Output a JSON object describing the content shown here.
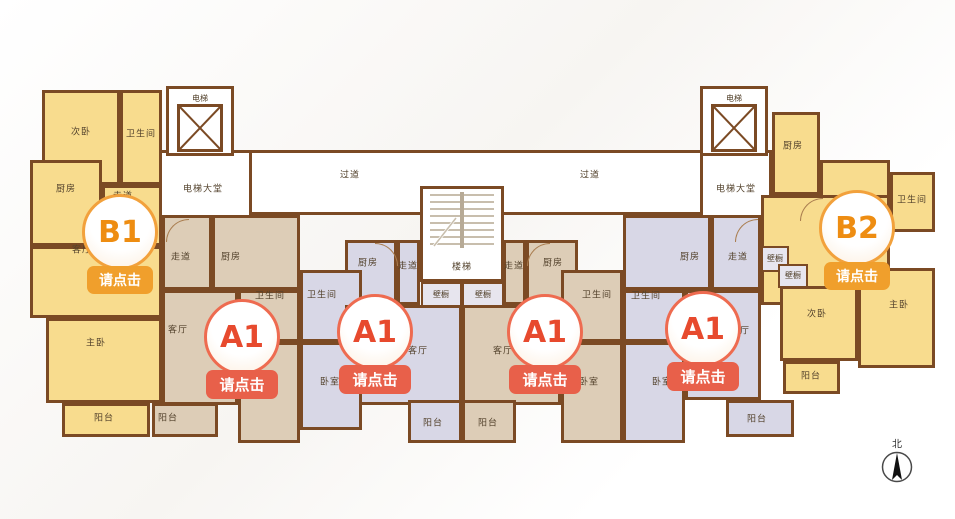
{
  "colors": {
    "wall": "#7b4a24",
    "unit_yellow": "#f8dc8e",
    "unit_tan": "#ddcdb7",
    "unit_lavender": "#d8d7e6",
    "closet_grey": "#e7e5ee",
    "badge_orange": "#f09f2c",
    "badge_red": "#e8604a"
  },
  "core": {
    "passage_left": "过道",
    "passage_right": "过道",
    "lobby_left": "电梯大堂",
    "lobby_right": "电梯大堂",
    "elevator_left": "电梯",
    "elevator_right": "电梯",
    "stairs": "楼梯",
    "closet_left": "壁橱",
    "closet_right": "壁橱"
  },
  "units": {
    "b1": {
      "id": "B1",
      "button": "请点击",
      "rooms": {
        "bedroom2": "次卧",
        "bathroom": "卫生间",
        "kitchen": "厨房",
        "hallway": "走道",
        "living": "客厅",
        "master": "主卧",
        "balcony": "阳台"
      }
    },
    "a1_first": {
      "id": "A1",
      "button": "请点击",
      "rooms": {
        "hallway": "走道",
        "kitchen": "厨房",
        "bathroom": "卫生间",
        "living": "客厅",
        "bedroom": "卧室",
        "balcony": "阳台"
      }
    },
    "a1_second": {
      "id": "A1",
      "button": "请点击",
      "rooms": {
        "kitchen": "厨房",
        "hallway": "走道",
        "bathroom": "卫生间",
        "living": "客厅",
        "bedroom": "卧室",
        "balcony": "阳台"
      }
    },
    "a1_third": {
      "id": "A1",
      "button": "请点击",
      "rooms": {
        "hallway": "走道",
        "kitchen": "厨房",
        "bathroom": "卫生间",
        "living": "客厅",
        "bedroom": "卧室",
        "balcony": "阳台"
      }
    },
    "a1_fourth": {
      "id": "A1",
      "button": "请点击",
      "rooms": {
        "kitchen": "厨房",
        "hallway": "走道",
        "bathroom": "卫生间",
        "living": "客厅",
        "bedroom": "卧室",
        "balcony": "阳台"
      }
    },
    "b2": {
      "id": "B2",
      "button": "请点击",
      "rooms": {
        "kitchen": "厨房",
        "bathroom": "卫生间",
        "living": "客厅",
        "closet1": "壁橱",
        "closet2": "壁橱",
        "bedroom2": "次卧",
        "master": "主卧",
        "balcony": "阳台"
      }
    }
  },
  "compass": {
    "north": "北"
  }
}
